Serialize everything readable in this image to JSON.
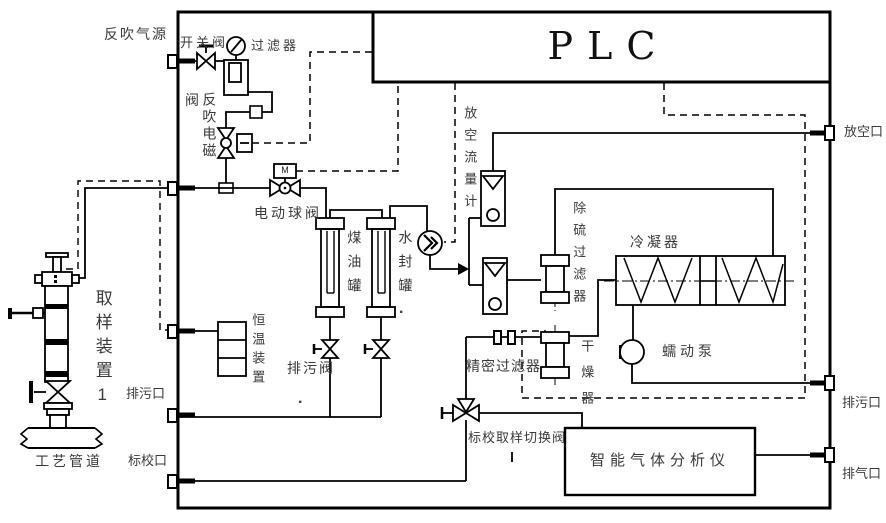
{
  "diagram": {
    "title": "gas sampling and analysis system P&ID",
    "labels": {
      "plc": "PLC",
      "backflush_gas_source": "反吹气源",
      "switch_valve": "开关阀",
      "filter": "过滤器",
      "valve_char": "阀",
      "backflush_solenoid": "反吹电磁",
      "electric_ball_valve": "电动球阀",
      "motor": "M",
      "kerosene_tank": "煤油罐",
      "water_seal_tank": "水封罐",
      "thermostat_device": "恒温装置",
      "drain_valve": "排污阀",
      "sampling_device": "取样装置1",
      "process_pipe": "工艺管道",
      "drain_port": "排污口",
      "calibration_port": "标校口",
      "vent_flowmeter": "放空流量计",
      "desulfurization_filter": "除硫过滤器",
      "condenser": "冷凝器",
      "dryer": "干燥器",
      "precision_filter": "精密过滤器",
      "peristaltic_pump": "蠕动泵",
      "calibration_sampling_switch_valve": "标校取样切换阀",
      "gas_analyzer": "智能气体分析仪",
      "vent_port": "放空口",
      "exhaust_port": "排气口",
      "dot": "."
    },
    "colors": {
      "line": "#000000",
      "label": "#3a3a3a",
      "background": "#ffffff"
    }
  }
}
